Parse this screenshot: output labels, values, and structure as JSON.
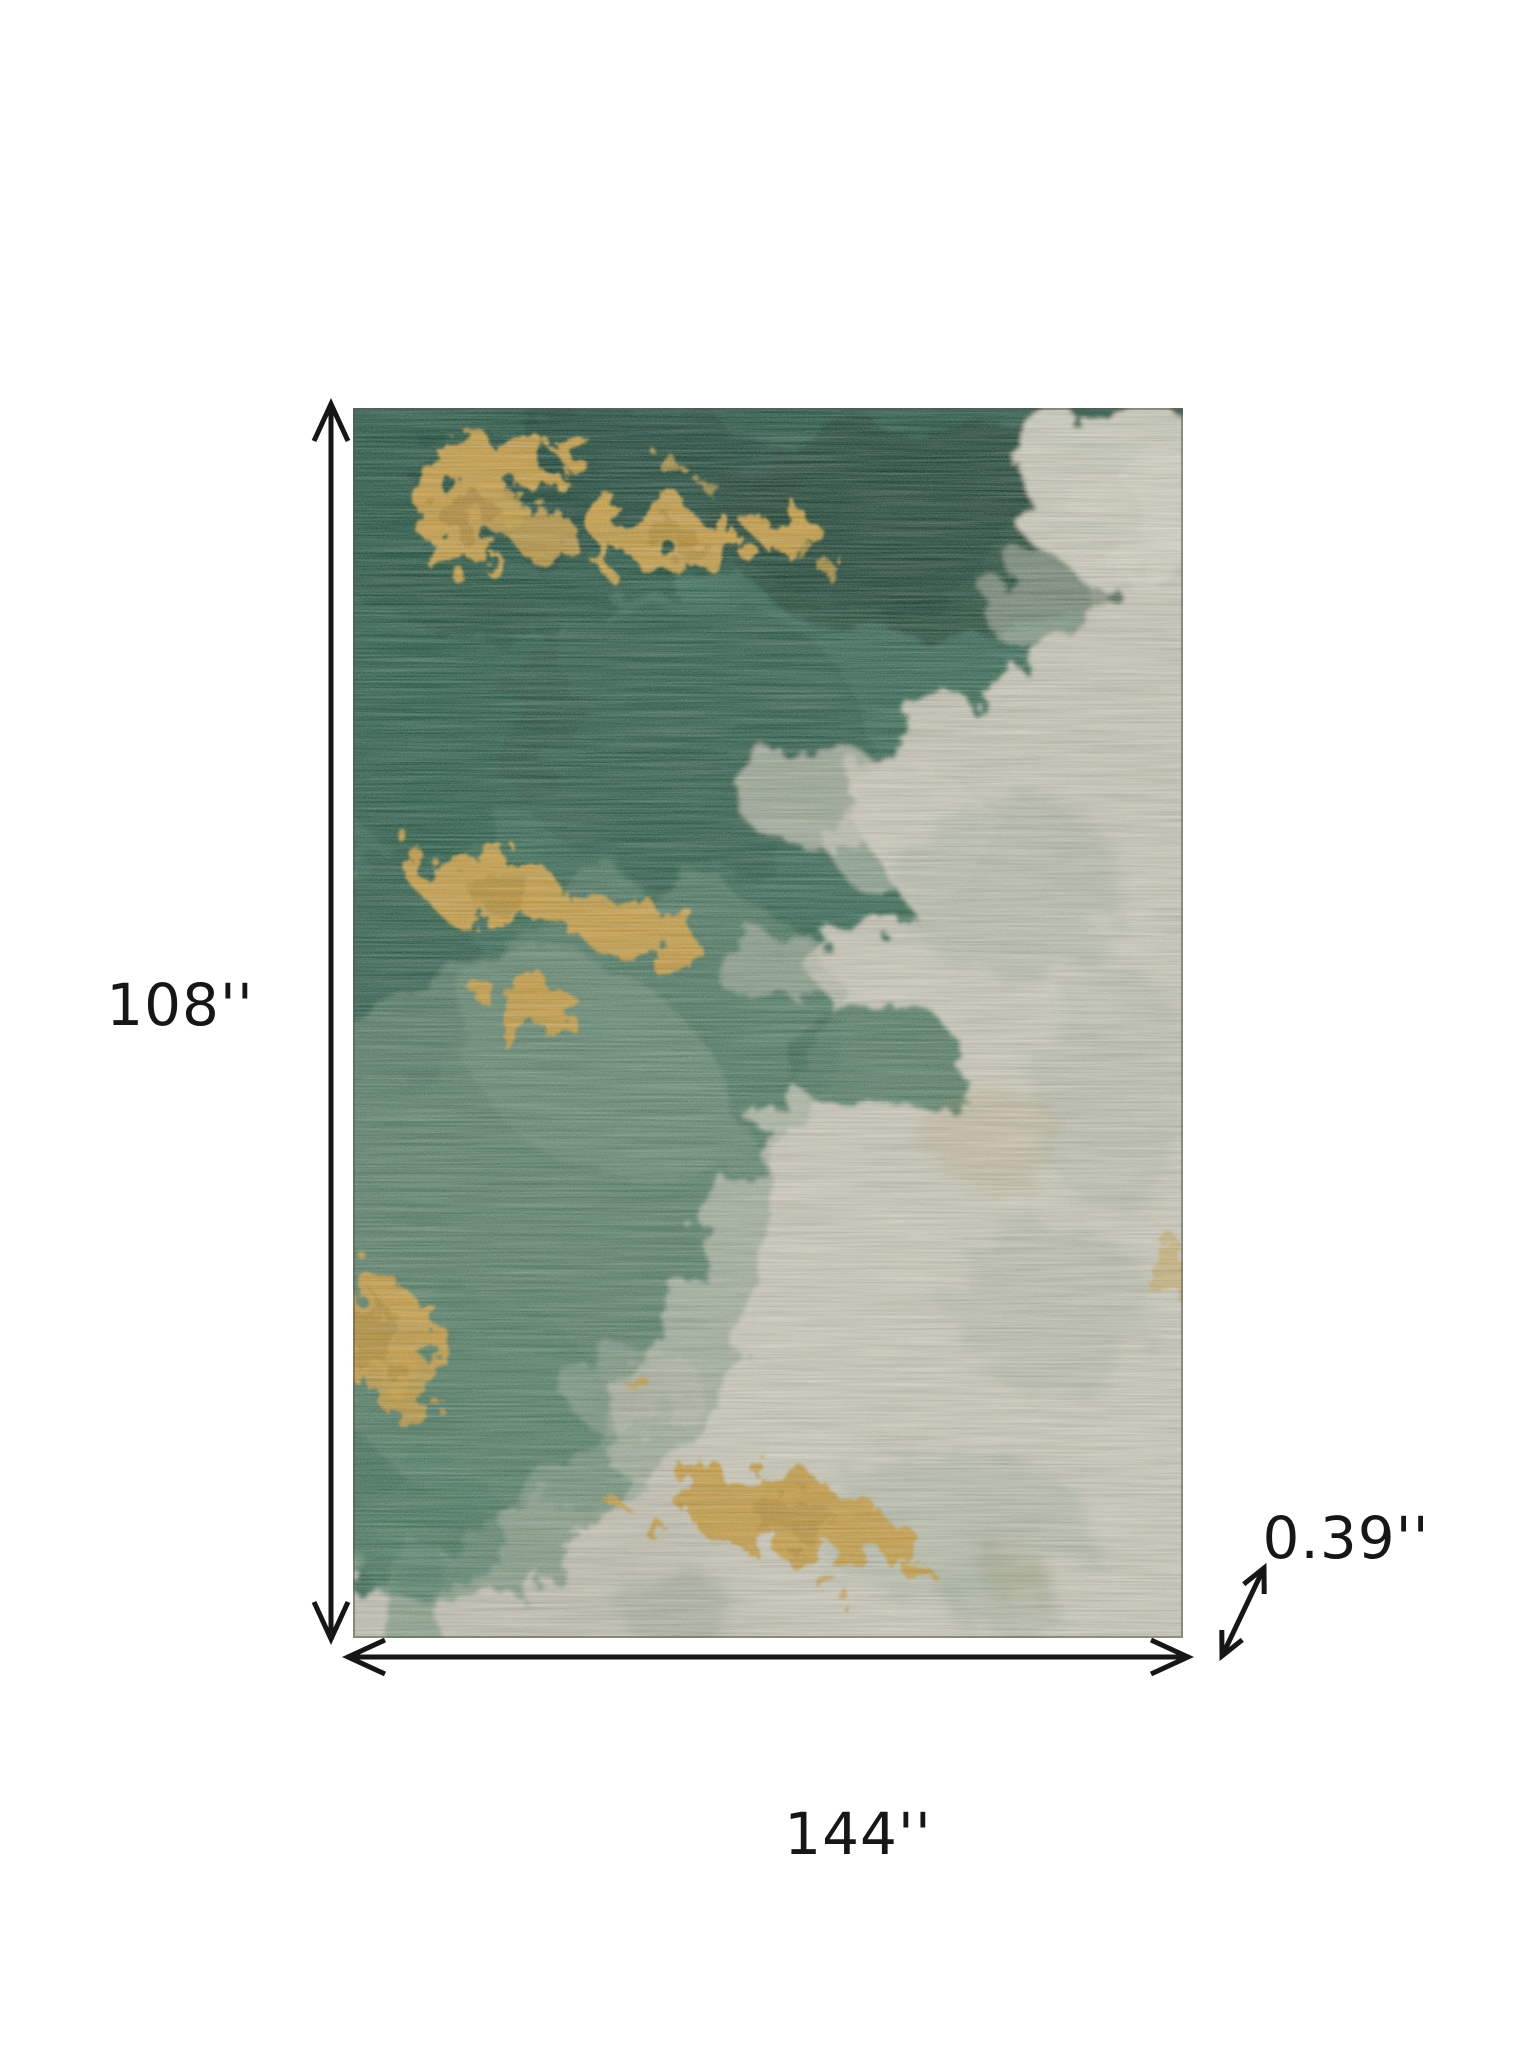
{
  "diagram": {
    "type": "product-dimensions",
    "product_description": "abstract watercolor area rug in green, gold and greige"
  },
  "dimensions": {
    "height": {
      "label": "108''",
      "value": 108,
      "unit": "inches"
    },
    "width": {
      "label": "144''",
      "value": 144,
      "unit": "inches"
    },
    "thickness": {
      "label": "0.39''",
      "value": 0.39,
      "unit": "inches"
    }
  },
  "theme": {
    "background": "#ffffff",
    "ink": "#161616",
    "greige": "#bcb9aa",
    "greige_light": "#cdcabb",
    "sage": "#74907a",
    "green": "#2f614b",
    "green_mid": "#3f7258",
    "dark_green": "#1d4b39",
    "darker_green": "#143829",
    "gold": "#c0953a",
    "gold_dark": "#9c7724",
    "gold_light": "#d6b666"
  }
}
